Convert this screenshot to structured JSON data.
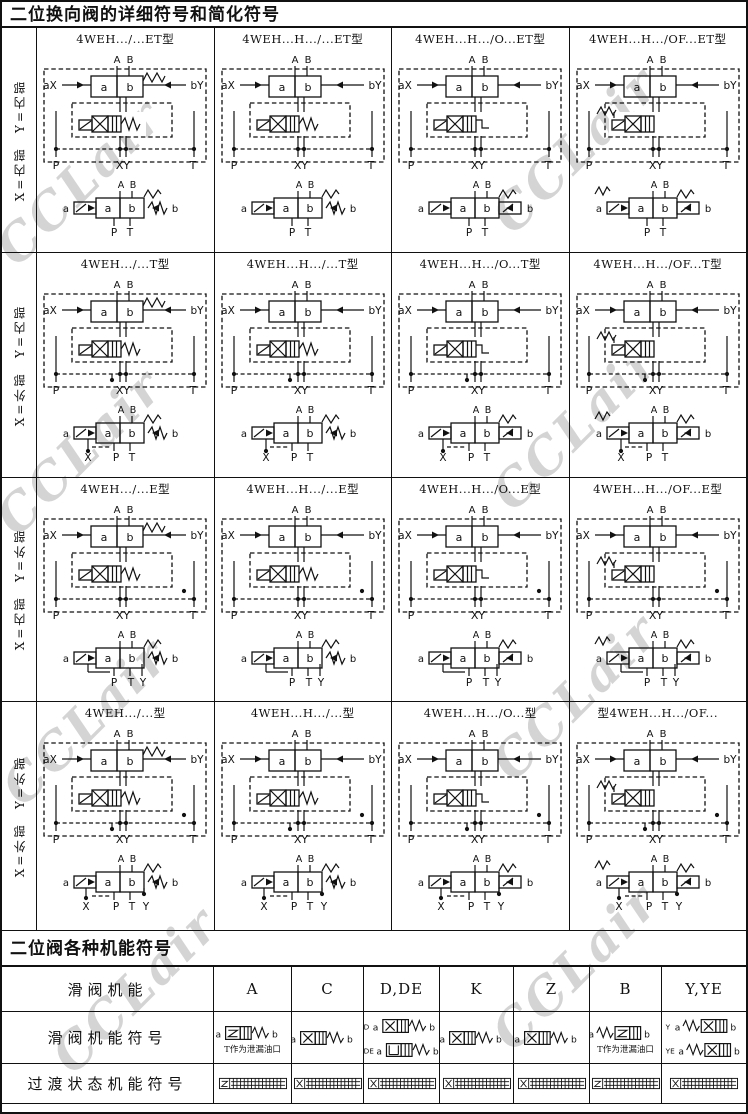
{
  "watermark": {
    "text": "CCLair",
    "color": "#b2b2b2"
  },
  "section1": {
    "title": "二位换向阀的详细符号和简化符号",
    "diagram_labels": {
      "A": "A",
      "B": "B",
      "a": "a",
      "b": "b",
      "aX": "aX",
      "bY": "bY",
      "P": "P",
      "XY": "XY",
      "T": "T",
      "X": "X",
      "Y": "Y"
    },
    "rows": [
      {
        "label": "X=内部  Y=内部",
        "cells": [
          {
            "header": "4WEH.../...ET型"
          },
          {
            "header": "4WEH...H.../...ET型"
          },
          {
            "header": "4WEH...H.../O...ET型"
          },
          {
            "header": "4WEH...H.../OF...ET型"
          }
        ]
      },
      {
        "label": "X=外部  Y=内部",
        "cells": [
          {
            "header": "4WEH.../...T型"
          },
          {
            "header": "4WEH...H.../...T型"
          },
          {
            "header": "4WEH...H.../O...T型"
          },
          {
            "header": "4WEH...H.../OF...T型"
          }
        ]
      },
      {
        "label": "X=内部  Y=外部",
        "cells": [
          {
            "header": "4WEH.../...E型"
          },
          {
            "header": "4WEH...H.../...E型"
          },
          {
            "header": "4WEH...H.../O...E型"
          },
          {
            "header": "4WEH...H.../OF...E型"
          }
        ]
      },
      {
        "label": "X=外部  Y=外部",
        "cells": [
          {
            "header": "4WEH.../...型"
          },
          {
            "header": "4WEH...H.../...型"
          },
          {
            "header": "4WEH...H.../O...型"
          },
          {
            "header": "型4WEH...H.../OF..."
          }
        ]
      }
    ]
  },
  "section2": {
    "title": "二位阀各种机能符号",
    "col_header_label": "滑阀机能",
    "columns": [
      "A",
      "C",
      "D,DE",
      "K",
      "Z",
      "B",
      "Y,YE"
    ],
    "row_symbol_label": "滑阀机能符号",
    "row_transition_label": "过渡状态机能符号",
    "leak_note": "T作为泄漏油口",
    "end_labels": {
      "a": "a",
      "b": "b"
    },
    "symbols": [
      {
        "column": "A",
        "items": [
          {
            "kind": "Z",
            "spring": "right"
          }
        ],
        "note": true
      },
      {
        "column": "C",
        "items": [
          {
            "kind": "X",
            "spring": "right"
          }
        ]
      },
      {
        "column": "D,DE",
        "items": [
          {
            "prefix": "D",
            "kind": "X",
            "spring": "right"
          },
          {
            "prefix": "DE",
            "kind": "U",
            "spring": "right"
          }
        ]
      },
      {
        "column": "K",
        "items": [
          {
            "kind": "X",
            "spring": "right"
          }
        ]
      },
      {
        "column": "Z",
        "items": [
          {
            "kind": "X",
            "spring": "right"
          }
        ]
      },
      {
        "column": "B",
        "items": [
          {
            "kind": "Z",
            "spring": "left"
          }
        ],
        "note": true
      },
      {
        "column": "Y,YE",
        "items": [
          {
            "prefix": "Y",
            "kind": "X",
            "spring": "left"
          },
          {
            "prefix": "YE",
            "kind": "X",
            "spring": "left"
          }
        ]
      }
    ],
    "transition_kinds": [
      "Z",
      "X",
      "X",
      "X",
      "X",
      "Z",
      "X"
    ]
  }
}
